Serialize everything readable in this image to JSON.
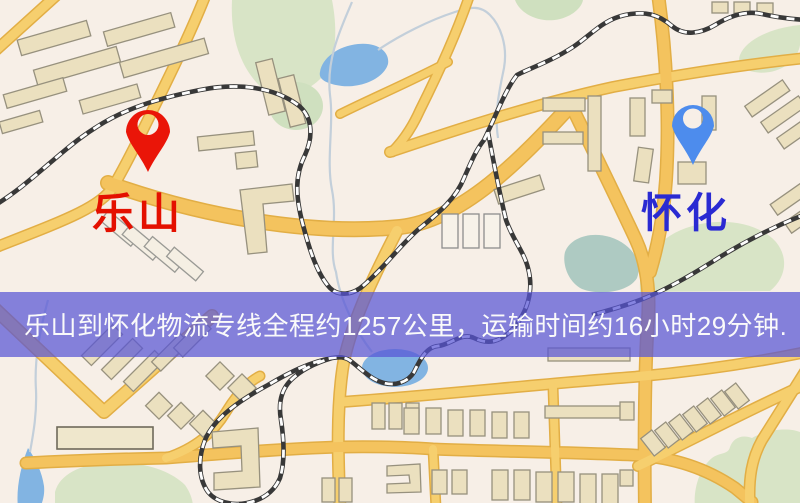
{
  "map": {
    "type": "logistics-route-map",
    "origin": {
      "label": "乐山",
      "label_color": "#e41000",
      "pin_color": "#ea1508"
    },
    "destination": {
      "label": "怀化",
      "label_color": "#2a2ad2",
      "pin_color": "#4d8ced"
    },
    "banner": {
      "text": "乐山到怀化物流专线全程约1257公里，运输时间约16小时29分钟.",
      "distance_km": "1257",
      "duration": "16小时29分钟",
      "background": "#5754d5",
      "text_color": "#fafafa"
    },
    "legend_colors": {
      "road_fill": "#f6cf6e",
      "road_casing": "#e2ae45",
      "building_fill": "#ebe0bf",
      "park_green": "#d8e4c6",
      "water_blue": "#82b4e2",
      "railway_dark": "#383838"
    }
  }
}
